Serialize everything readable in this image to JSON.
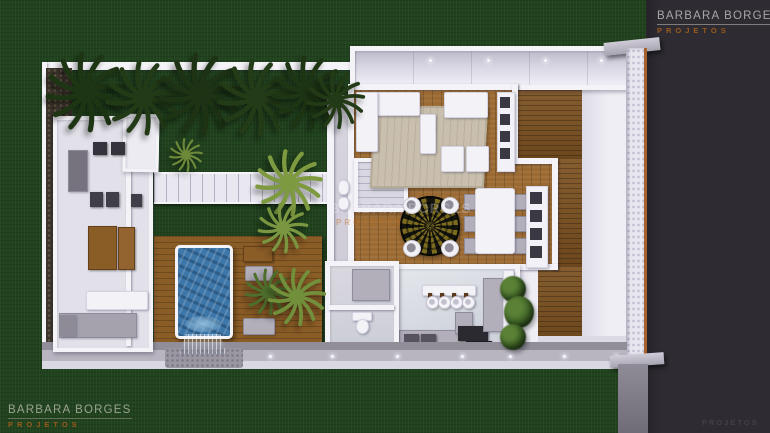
{
  "brand": {
    "name": "BARBARA BORGES",
    "subtitle": "PROJETOS"
  },
  "watermarks": {
    "top_right": {
      "line1": "BARBARA BORGES",
      "line2": "PROJETOS"
    },
    "bottom_left": {
      "line1": "BARBARA BORGES",
      "line2": "PROJETOS"
    },
    "center": {
      "line1": "BARBARA BORGES",
      "line2": "PROJETOS"
    },
    "bottom_right": {
      "line1": "PROJETOS"
    }
  },
  "colors": {
    "grass": "#20421d",
    "backdrop": "#2e2c32",
    "wall": "#f4f3f8",
    "stone": "#3b342b",
    "pebble": "#e8e6ee",
    "pool_deck_wood": "#8a5c26",
    "deck_wood": "#7c5120",
    "floor_wood": "#9c6b33",
    "pool_water": "#3d76a8",
    "rug": "#c9bfae",
    "table_wood": "#8a5c26",
    "appliance": "#2c2a31",
    "palm_dark": "#213916",
    "palm_light": "#7e9a40",
    "brand_gray": "#a6a6a6",
    "brand_orange": "#9a5a1c",
    "trim_orange": "#a5622c"
  }
}
